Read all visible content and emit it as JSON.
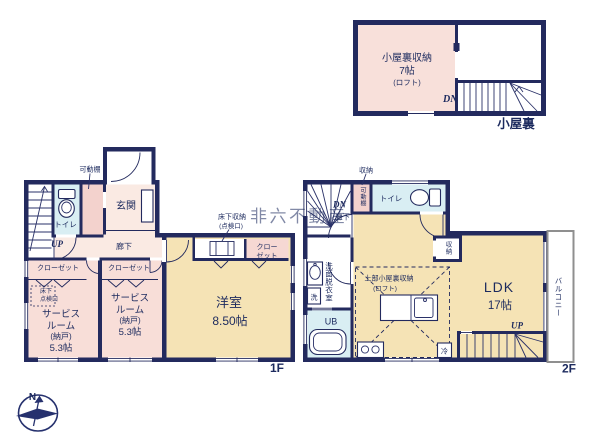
{
  "watermark": "非六不動産",
  "compass": {
    "north": "N"
  },
  "attic": {
    "floor_label": "小屋裏",
    "storage_room": {
      "name": "小屋裏収納",
      "size": "7帖",
      "note": "(ロフト)"
    },
    "stairs_down": "DN"
  },
  "f1": {
    "floor_label": "1F",
    "movable_shelf": "可動棚",
    "toilet": "トイレ",
    "entrance": "玄関",
    "stairs_up": "UP",
    "hallway": "廊下",
    "closet_a": "クローゼット",
    "closet_b": "クローゼット",
    "closet_c1": "クロー",
    "closet_c2": "ゼット",
    "underfloor_label1": "床下収納",
    "underfloor_label2": "(点検口)",
    "hatch1": "床下",
    "hatch2": "点検口",
    "service_a": {
      "l1": "サービス",
      "l2": "ルーム",
      "l3": "(納戸)",
      "l4": "5.3帖"
    },
    "service_b": {
      "l1": "サービス",
      "l2": "ルーム",
      "l3": "(納戸)",
      "l4": "5.3帖"
    },
    "western": {
      "name": "洋室",
      "size": "8.50帖"
    }
  },
  "f2": {
    "floor_label": "2F",
    "storage_top": "収納",
    "movable_shelf": "可動棚",
    "toilet": "トイレ",
    "stairs_down": "DN",
    "hallway": "廊下",
    "washroom": "洗面脱衣室",
    "washer": "洗",
    "unit_bath": "UB",
    "loft1": "上部小屋裏収納",
    "loft2": "(ロフト)",
    "ldk": {
      "name": "LDK",
      "size": "17帖"
    },
    "storage_side": "収納",
    "fridge": "冷",
    "stairs_up": "UP",
    "balcony": "バルコニー"
  }
}
